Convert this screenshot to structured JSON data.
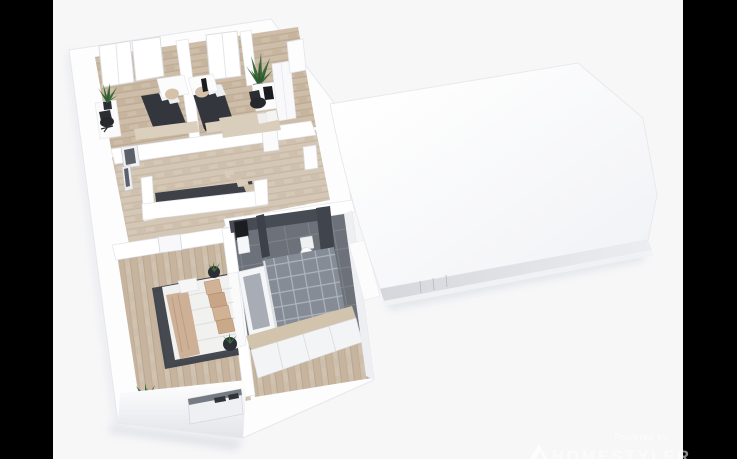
{
  "canvas": {
    "width": 737,
    "height": 459,
    "letterbox_color": "#000000",
    "background_color": "#f7f7f8"
  },
  "watermark": {
    "powered_by": "Powered by",
    "brand": "HOMESTYLER"
  },
  "scene": {
    "type": "3D dollhouse floor-plan rendering of an upper floor, viewed from above at an angle",
    "sections": [
      {
        "name": "open-floor-plan-section",
        "state": "roof removed, interior visible",
        "rooms": [
          {
            "name": "bedroom-1",
            "furniture": [
              "dark double bed with white pillow",
              "white desk with beige chair",
              "white cabinet with potted plant",
              "black office chair",
              "two windows",
              "beige runner"
            ]
          },
          {
            "name": "bedroom-2",
            "furniture": [
              "dark bed with white pillow",
              "white desk with beige chair",
              "wall-mounted tv",
              "tall window"
            ]
          },
          {
            "name": "bedroom-3",
            "furniture": [
              "white desk with monitor",
              "black office chair",
              "white wardrobe",
              "tall potted plant",
              "beige daybed with white pillows",
              "door"
            ]
          },
          {
            "name": "landing",
            "furniture": [
              "stairwell with white half-walls",
              "wooden staircase",
              "doors"
            ]
          },
          {
            "name": "master-bedroom",
            "furniture": [
              "double bed with white duvet, beige throw and beige pillows",
              "dark gray rug",
              "two round planters",
              "floor plant",
              "door"
            ]
          },
          {
            "name": "bathroom",
            "furniture": [
              "washbasin with dark mirror",
              "toilet",
              "bathtub",
              "walk-in shower with glass panel",
              "wooden vanity with white fronts",
              "dark gray wall and floor tiles"
            ]
          }
        ]
      },
      {
        "name": "adjoining-roof-section",
        "state": "roof still closed, rendered plain white"
      }
    ]
  },
  "colors": {
    "background": "#f7f7f8",
    "letterbox": "#000000",
    "walls": "#ffffff",
    "wood_floor": "#cdbda9",
    "dark_furniture": "#33363c",
    "rug_dark": "#43464c",
    "bath_tile_dark": "#6c717a",
    "bath_tile_light": "#868c96",
    "textile_beige": "#d2b294",
    "plant_green": "#3c6b3c",
    "watermark_text": "#ffffff"
  }
}
